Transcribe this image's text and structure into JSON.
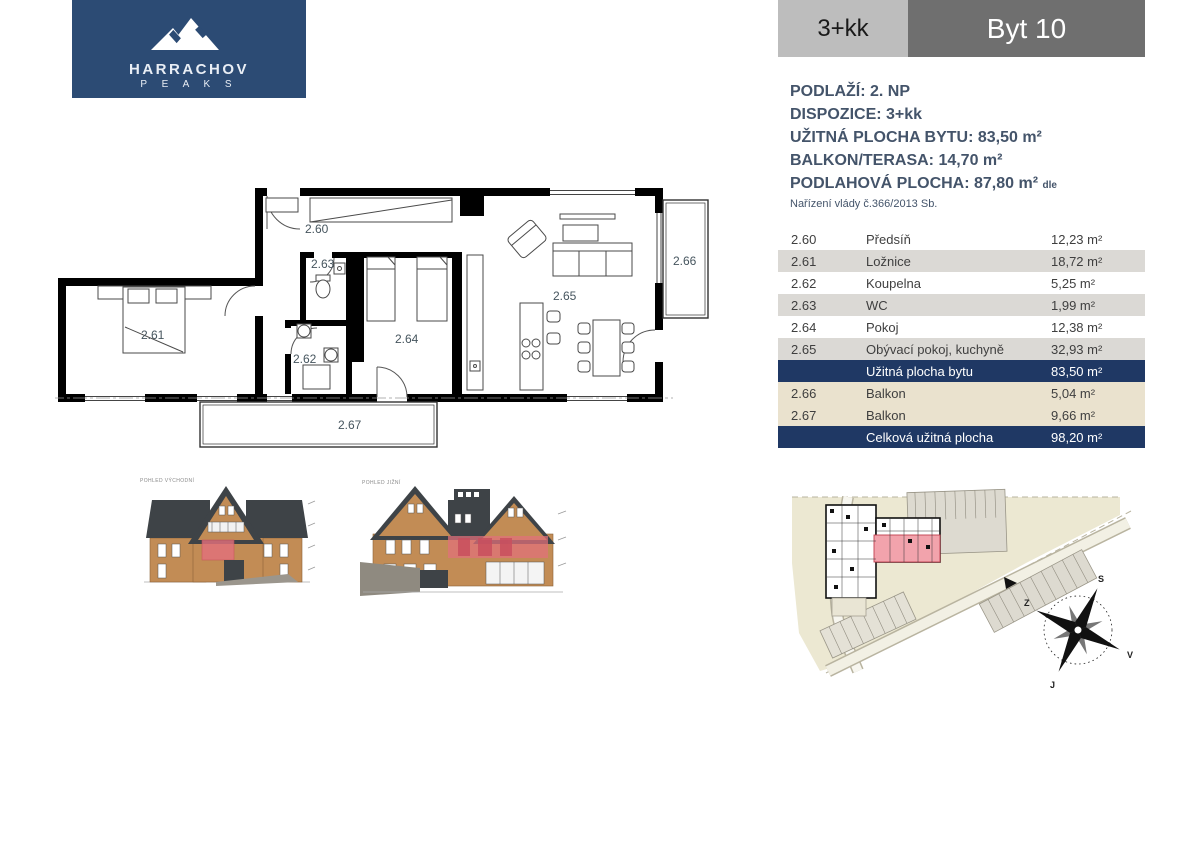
{
  "logo": {
    "name": "HARRACHOV",
    "sub": "P E A K S"
  },
  "header": {
    "layout": "3+kk",
    "unit": "Byt 10"
  },
  "info": {
    "line1": "PODLAŽÍ: 2. NP",
    "line2": "DISPOZICE: 3+kk",
    "line3": "UŽITNÁ PLOCHA BYTU: 83,50 m²",
    "line4": "BALKON/TERASA: 14,70 m²",
    "line5": "PODLAHOVÁ PLOCHA: 87,80 m²",
    "line5_suffix": "dle",
    "line6": "Nařízení vlády č.366/2013 Sb."
  },
  "table": {
    "rows": [
      {
        "code": "2.60",
        "name": "Předsíň",
        "area": "12,23 m²"
      },
      {
        "code": "2.61",
        "name": "Ložnice",
        "area": "18,72 m²"
      },
      {
        "code": "2.62",
        "name": "Koupelna",
        "area": "5,25 m²"
      },
      {
        "code": "2.63",
        "name": "WC",
        "area": "1,99 m²"
      },
      {
        "code": "2.64",
        "name": "Pokoj",
        "area": "12,38 m²"
      },
      {
        "code": "2.65",
        "name": "Obývací pokoj, kuchyně",
        "area": "32,93 m²"
      },
      {
        "code": "",
        "name": "Užitná plocha bytu",
        "area": "83,50 m²"
      },
      {
        "code": "2.66",
        "name": "Balkon",
        "area": "5,04 m²"
      },
      {
        "code": "2.67",
        "name": "Balkon",
        "area": "9,66 m²"
      },
      {
        "code": "",
        "name": "Celková užitná plocha",
        "area": "98,20 m²"
      }
    ]
  },
  "plan": {
    "labels": {
      "hall": "2.60",
      "bedroom": "2.61",
      "bath": "2.62",
      "wc": "2.63",
      "room": "2.64",
      "living": "2.65",
      "balcony_east": "2.66",
      "balcony_south": "2.67"
    }
  },
  "elevations": {
    "label_left": "POHLED VÝCHODNÍ",
    "label_right": "POHLED JIŽNÍ"
  },
  "site": {
    "compass": {
      "north": "S",
      "east": "V",
      "south": "J",
      "west": "Z"
    }
  },
  "colors": {
    "logo_bg": "#2C4B74",
    "navy_row": "#1F3864",
    "shade_row": "#DBD9D5",
    "beige_row": "#EAE2CE",
    "header_light": "#BDBDBD",
    "header_dark": "#6F6F6F",
    "info_text": "#44546A",
    "highlight_pink": "#E2707C",
    "facade_tan": "#C28C55",
    "roof_dark": "#3E4347",
    "site_beige": "#ECE8D2"
  }
}
